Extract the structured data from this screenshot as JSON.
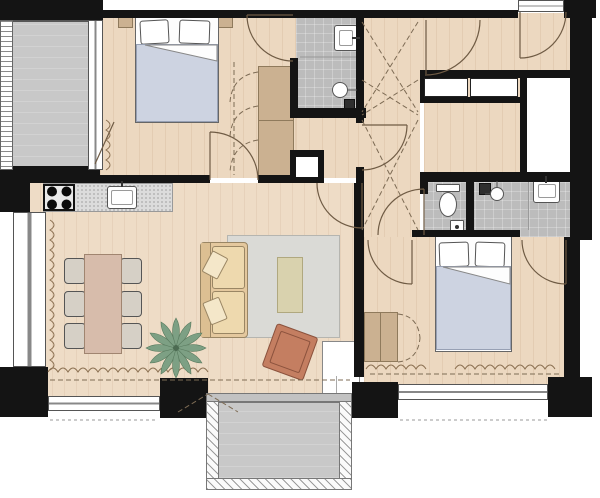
{
  "plan": {
    "type": "apartment-floor-plan",
    "canvas": {
      "width": 600,
      "height": 498
    },
    "palette": {
      "wall": "#141414",
      "wood_floor": "#ecd8c0",
      "living_floor": "#eedcc6",
      "tile_gray": "#bcbcbc",
      "balcony_gray": "#c8c8c8",
      "rug_gray": "#dadad6",
      "sofa_tan": "#e4c89e",
      "armchair_terracotta": "#c47e61",
      "dining_table_rose": "#d7bcab",
      "wardrobe_tan": "#cbb191",
      "bedding_blue": "#cdd3e1",
      "plant_green": "#7da084",
      "window_white": "#ffffff"
    },
    "rooms": [
      {
        "id": "bedroom-1",
        "furniture": [
          "double-bed",
          "pillows",
          "nightstand-left",
          "nightstand-right",
          "wardrobe",
          "curtain"
        ]
      },
      {
        "id": "ensuite-wc",
        "furniture": [
          "washbasin",
          "toilet",
          "floor-drain"
        ]
      },
      {
        "id": "entry-hall",
        "furniture": [
          "entry-door",
          "built-in-closet-a",
          "built-in-closet-b"
        ]
      },
      {
        "id": "hallway",
        "furniture": [
          "void-cross-marking"
        ]
      },
      {
        "id": "storage-room",
        "furniture": []
      },
      {
        "id": "shaft",
        "furniture": []
      },
      {
        "id": "wc",
        "furniture": [
          "toilet",
          "bin"
        ]
      },
      {
        "id": "bathroom",
        "furniture": [
          "shower",
          "shower-head",
          "washbasin"
        ]
      },
      {
        "id": "bedroom-2",
        "furniture": [
          "double-bed",
          "pillows",
          "dresser",
          "curtain"
        ]
      },
      {
        "id": "living-room-kitchen",
        "furniture": [
          "cooktop",
          "kitchen-counter",
          "kitchen-sink",
          "dining-table",
          "six-chairs",
          "sofa",
          "rug",
          "coffee-table",
          "armchair",
          "plant",
          "corner-unit",
          "curtain"
        ]
      },
      {
        "id": "balcony-top",
        "furniture": [
          "railing"
        ]
      },
      {
        "id": "balcony-bottom",
        "furniture": [
          "railing"
        ]
      }
    ]
  }
}
